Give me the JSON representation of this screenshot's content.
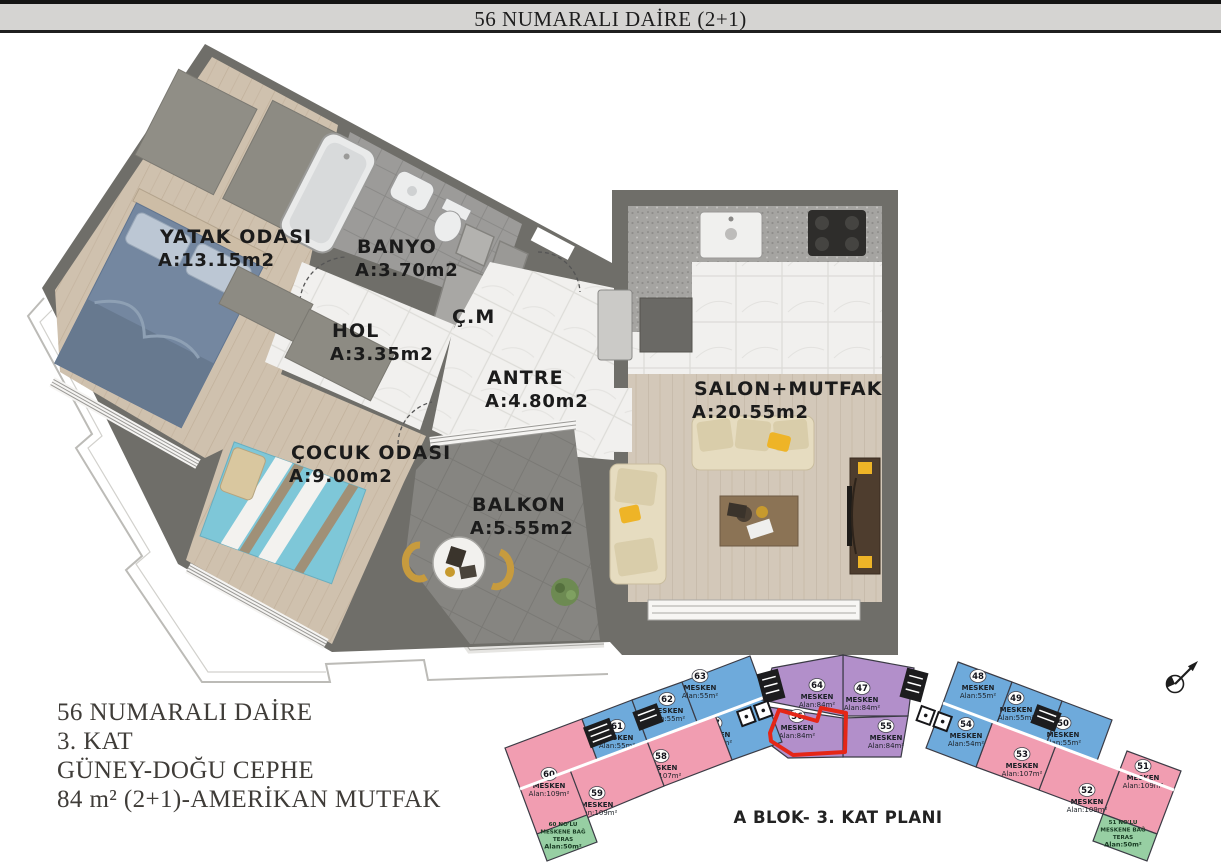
{
  "header": {
    "title": "56 NUMARALI DAİRE (2+1)"
  },
  "rooms": [
    {
      "name": "YATAK ODASI",
      "area": "A:13.15m2"
    },
    {
      "name": "BANYO",
      "area": "A:3.70m2"
    },
    {
      "name": "HOL",
      "area": "A:3.35m2"
    },
    {
      "name": "Ç.M",
      "area": ""
    },
    {
      "name": "ANTRE",
      "area": "A:4.80m2"
    },
    {
      "name": "SALON+MUTFAK",
      "area": "A:20.55m2"
    },
    {
      "name": "ÇOCUK ODASI",
      "area": "A:9.00m2"
    },
    {
      "name": "BALKON",
      "area": "A:5.55m2"
    }
  ],
  "info": {
    "lines": [
      "56 NUMARALI DAİRE",
      "3. KAT",
      "GÜNEY-DOĞU CEPHE",
      "84 m² (2+1)-AMERİKAN MUTFAK"
    ]
  },
  "keyplan": {
    "title": "A BLOK- 3. KAT PLANI",
    "units": [
      {
        "no": "47",
        "label": "MESKEN",
        "area": "Alan:84m²",
        "color": "purple",
        "highlighted": false
      },
      {
        "no": "48",
        "label": "MESKEN",
        "area": "Alan:55m²",
        "color": "blue",
        "highlighted": false
      },
      {
        "no": "49",
        "label": "MESKEN",
        "area": "Alan:55m²",
        "color": "blue",
        "highlighted": false
      },
      {
        "no": "50",
        "label": "MESKEN",
        "area": "Alan:55m²",
        "color": "blue",
        "highlighted": false
      },
      {
        "no": "51",
        "label": "MESKEN",
        "area": "Alan:109m²",
        "color": "pink",
        "highlighted": false
      },
      {
        "no": "52",
        "label": "MESKEN",
        "area": "Alan:109m²",
        "color": "pink",
        "highlighted": false
      },
      {
        "no": "53",
        "label": "MESKEN",
        "area": "Alan:107m²",
        "color": "pink",
        "highlighted": false
      },
      {
        "no": "54",
        "label": "MESKEN",
        "area": "Alan:54m²",
        "color": "blue",
        "highlighted": false
      },
      {
        "no": "55",
        "label": "MESKEN",
        "area": "Alan:84m²",
        "color": "purple",
        "highlighted": false
      },
      {
        "no": "56",
        "label": "MESKEN",
        "area": "Alan:84m²",
        "color": "purple",
        "highlighted": true
      },
      {
        "no": "57",
        "label": "MESKEN",
        "area": "Alan:55m²",
        "color": "blue",
        "highlighted": false
      },
      {
        "no": "58",
        "label": "MESKEN",
        "area": "Alan:107m²",
        "color": "pink",
        "highlighted": false
      },
      {
        "no": "59",
        "label": "MESKEN",
        "area": "Alan:109m²",
        "color": "pink",
        "highlighted": false
      },
      {
        "no": "60",
        "label": "MESKEN",
        "area": "Alan:109m²",
        "color": "pink",
        "highlighted": false
      },
      {
        "no": "61",
        "label": "MESKEN",
        "area": "Alan:55m²",
        "color": "blue",
        "highlighted": false
      },
      {
        "no": "62",
        "label": "MESKEN",
        "area": "Alan:55m²",
        "color": "blue",
        "highlighted": false
      },
      {
        "no": "63",
        "label": "MESKEN",
        "area": "Alan:55m²",
        "color": "blue",
        "highlighted": false
      },
      {
        "no": "64",
        "label": "MESKEN",
        "area": "Alan:84m²",
        "color": "purple",
        "highlighted": false
      }
    ],
    "terraces": [
      {
        "lines": [
          "60 NO'LU",
          "MESKENE BAĞ",
          "TERAS",
          "Alan:50m²"
        ]
      },
      {
        "lines": [
          "51 NO'LU",
          "MESKENE BAĞ",
          "TERAS",
          "Alan:50m²"
        ]
      }
    ],
    "colors": {
      "blue": "#6eaadb",
      "pink": "#f19db1",
      "purple": "#b28fca",
      "green": "#97cfa3",
      "highlight": "#e52617"
    }
  }
}
